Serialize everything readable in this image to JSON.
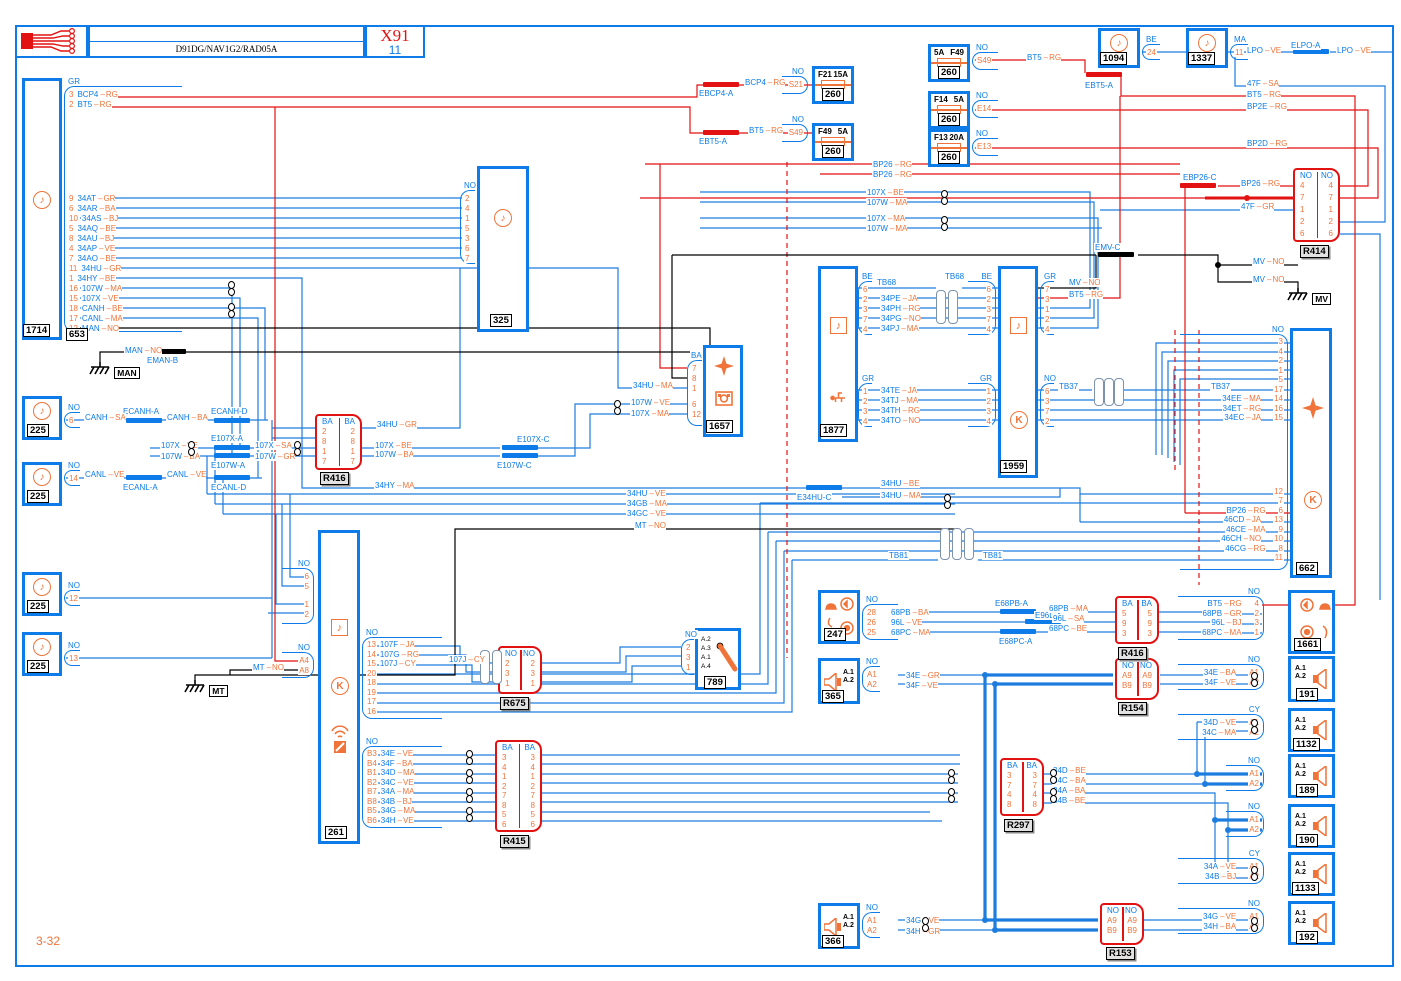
{
  "header": {
    "product": "D91DG/NAV1G2/RAD05A",
    "code": "X91",
    "sheet": "11"
  },
  "footer": {
    "page": "3-32"
  },
  "g": {
    "man": "MAN",
    "mt": "MT",
    "mv": "MV"
  },
  "s": {
    "eman": "EMAN-B",
    "ecanh_a": "ECANH-A",
    "ecanh_d": "ECANH-D",
    "ecanl_a": "ECANL-A",
    "ecanl_d": "ECANL-D",
    "e107x_a": "E107X-A",
    "e107w_a": "E107W-A",
    "e107x_c": "E107X-C",
    "e107w_c": "E107W-C",
    "ebcp4": "EBCP4-A",
    "ebt5_a": "EBT5-A",
    "ebt5_b": "EBT5-A",
    "ebp26": "EBP26-C",
    "elpo": "ELPO-A",
    "emv": "EMV-C",
    "e34hu": "E34HU-C",
    "e68pb": "E68PB-A",
    "e96l": "E96L-A",
    "e68pc": "E68PC-A"
  },
  "c1714": {
    "tag": "1714",
    "tag2": "653",
    "conn": "GR",
    "pins_a": [
      {
        "p": "3",
        "n": "BCP4",
        "c": "RG"
      },
      {
        "p": "2",
        "n": "BT5",
        "c": "RG"
      }
    ],
    "pins_b": [
      {
        "p": "9",
        "n": "34AT",
        "c": "GR"
      },
      {
        "p": "6",
        "n": "34AR",
        "c": "BA"
      },
      {
        "p": "10",
        "n": "34AS",
        "c": "BJ"
      },
      {
        "p": "5",
        "n": "34AQ",
        "c": "BE"
      },
      {
        "p": "8",
        "n": "34AU",
        "c": "BJ"
      },
      {
        "p": "4",
        "n": "34AP",
        "c": "VE"
      },
      {
        "p": "7",
        "n": "34AO",
        "c": "BE"
      },
      {
        "p": "11",
        "n": "34HU",
        "c": "GR"
      },
      {
        "p": "1",
        "n": "34HY",
        "c": "BE"
      },
      {
        "p": "16",
        "n": "107W",
        "c": "MA"
      },
      {
        "p": "15",
        "n": "107X",
        "c": "VE"
      },
      {
        "p": "18",
        "n": "CANH",
        "c": "BE"
      },
      {
        "p": "17",
        "n": "CANL",
        "c": "MA"
      },
      {
        "p": "12",
        "n": "MAN",
        "c": "NO"
      }
    ]
  },
  "b225": [
    {
      "tag": "225",
      "conn": "NO",
      "p": "6"
    },
    {
      "tag": "225",
      "conn": "NO",
      "p": "14"
    },
    {
      "tag": "225",
      "conn": "NO",
      "p": "12"
    },
    {
      "tag": "225",
      "conn": "NO",
      "p": "13"
    }
  ],
  "c325": {
    "tag": "325",
    "conn": "NO",
    "pins": [
      "2",
      "4",
      "1",
      "5",
      "3",
      "6",
      "7"
    ]
  },
  "c1657": {
    "tag": "1657",
    "conn": "BA",
    "pins1": [
      {
        "p": "7"
      },
      {
        "p": "8"
      },
      {
        "p": "1",
        "n": "34HU",
        "c": "MA"
      }
    ],
    "pins2": [
      {
        "p": "6",
        "n": "107W",
        "c": "VE"
      },
      {
        "p": "12",
        "n": "107X",
        "c": "MA"
      }
    ]
  },
  "r416a": {
    "tag": "R416",
    "hl": "BA",
    "hr": "BA",
    "pins": [
      "2",
      "8",
      "1",
      "7"
    ]
  },
  "fusesL": [
    {
      "f1": "F21",
      "f2": "15A",
      "conn": "NO",
      "pin": "S21",
      "tag": "260"
    },
    {
      "f1": "F49",
      "f2": "5A",
      "conn": "NO",
      "pin": "S49",
      "tag": "260"
    }
  ],
  "fusesR": [
    {
      "f1": "5A",
      "f2": "F49",
      "conn": "NO",
      "pin": "S49",
      "tag": "260"
    },
    {
      "f1": "F14",
      "f2": "5A",
      "conn": "NO",
      "pin": "E14",
      "tag": "260"
    },
    {
      "f1": "F13",
      "f2": "20A",
      "conn": "NO",
      "pin": "E13",
      "tag": "260"
    }
  ],
  "c1094": {
    "tag": "1094",
    "conn": "BE",
    "pin": "24"
  },
  "c1337": {
    "tag": "1337",
    "conn": "MA",
    "pin": "11"
  },
  "r414": {
    "tag": "R414",
    "hl": "NO",
    "hr": "NO",
    "pins": [
      "4",
      "7",
      "1",
      "2",
      "6"
    ]
  },
  "c1877": {
    "tag": "1877",
    "connA": "BE",
    "pinsA": [
      {
        "p": "6",
        "n": "TB68",
        "c": ""
      },
      {
        "p": "2",
        "n": "34PE",
        "c": "JA"
      },
      {
        "p": "3",
        "n": "34PH",
        "c": "RG"
      },
      {
        "p": "7",
        "n": "34PG",
        "c": "NO"
      },
      {
        "p": "4",
        "n": "34PJ",
        "c": "MA"
      }
    ],
    "connB": "GR",
    "pinsB": [
      {
        "p": "1",
        "n": "34TE",
        "c": "JA"
      },
      {
        "p": "2",
        "n": "34TJ",
        "c": "MA"
      },
      {
        "p": "3",
        "n": "34TH",
        "c": "RG"
      },
      {
        "p": "4",
        "n": "34TO",
        "c": "NO"
      }
    ]
  },
  "c1959": {
    "tag": "1959",
    "connL1": "BE",
    "pinsL1": [
      "6",
      "2",
      "3",
      "7",
      "4"
    ],
    "connL2": "GR",
    "pinsL2": [
      "1",
      "2",
      "3",
      "4"
    ],
    "connR1": "GR",
    "pinsR1": [
      "7",
      "3",
      "1",
      "2",
      "4"
    ],
    "connR2": "NO",
    "pinsR2": [
      "6",
      "3",
      "7",
      "2"
    ]
  },
  "c662": {
    "tag": "662",
    "conn": "NO",
    "pins1": [
      {
        "p": "3"
      },
      {
        "p": "4"
      },
      {
        "p": "2"
      },
      {
        "p": "1"
      },
      {
        "p": "5"
      },
      {
        "p": "17"
      },
      {
        "p": "14",
        "n": "34EE",
        "c": "MA"
      },
      {
        "p": "16",
        "n": "34ET",
        "c": "RG"
      },
      {
        "p": "15",
        "n": "34EC",
        "c": "JA"
      }
    ],
    "pins2": [
      {
        "p": "12"
      },
      {
        "p": "7"
      },
      {
        "p": "6",
        "n": "BP26",
        "c": "RG"
      },
      {
        "p": "13",
        "n": "46CD",
        "c": "JA"
      },
      {
        "p": "9",
        "n": "46CE",
        "c": "MA"
      },
      {
        "p": "10",
        "n": "46CH",
        "c": "NO"
      },
      {
        "p": "8",
        "n": "46CG",
        "c": "RG"
      },
      {
        "p": "11"
      }
    ]
  },
  "c261": {
    "tag": "261",
    "connTL": "NO",
    "pinsTL1": [
      "6",
      "5"
    ],
    "pinsTL2": [
      "1",
      "2"
    ],
    "connBL": "NO",
    "pinsBL": [
      "A4",
      "A8"
    ],
    "connR1": "NO",
    "pinsR1": [
      {
        "p": "13",
        "n": "107F",
        "c": "JA"
      },
      {
        "p": "14",
        "n": "107G",
        "c": "RG"
      },
      {
        "p": "15",
        "n": "107J",
        "c": "CY"
      },
      {
        "p": "20"
      },
      {
        "p": "18"
      },
      {
        "p": "19"
      },
      {
        "p": "17"
      },
      {
        "p": "16"
      }
    ],
    "connR2": "NO",
    "pinsR2": [
      {
        "p": "B3",
        "n": "34E",
        "c": "VE"
      },
      {
        "p": "B4",
        "n": "34F",
        "c": "BA"
      },
      {
        "p": "B1",
        "n": "34D",
        "c": "MA"
      },
      {
        "p": "B2",
        "n": "34C",
        "c": "VE"
      },
      {
        "p": "B7",
        "n": "34A",
        "c": "MA"
      },
      {
        "p": "B8",
        "n": "34B",
        "c": "BJ"
      },
      {
        "p": "B5",
        "n": "34G",
        "c": "MA"
      },
      {
        "p": "B6",
        "n": "34H",
        "c": "VE"
      }
    ]
  },
  "r675": {
    "tag": "R675",
    "hl": "NO",
    "hr": "NO",
    "pins": [
      "2",
      "3",
      "1"
    ]
  },
  "c789": {
    "tag": "789",
    "conn": "NO",
    "pins": [
      "2",
      "3",
      "1"
    ],
    "labels": [
      "A.2",
      "A.3",
      "A.1",
      "A.4"
    ]
  },
  "r415": {
    "tag": "R415",
    "hl": "BA",
    "hr": "BA",
    "pins": [
      "3",
      "4",
      "1",
      "2",
      "7",
      "8",
      "5",
      "6"
    ]
  },
  "c247": {
    "tag": "247",
    "conn": "NO",
    "pins": [
      {
        "p": "28",
        "n": "68PB",
        "c": "BA"
      },
      {
        "p": "26",
        "n": "96L",
        "c": "VE"
      },
      {
        "p": "25",
        "n": "68PC",
        "c": "MA"
      }
    ]
  },
  "r416b": {
    "tag": "R416",
    "hl": "BA",
    "hr": "BA",
    "pins": [
      "5",
      "9",
      "3"
    ]
  },
  "c1661": {
    "tag": "1661",
    "conn": "NO",
    "pins": [
      {
        "p": "4",
        "n": "BT5",
        "c": "RG"
      },
      {
        "p": "2",
        "n": "68PB",
        "c": "GR"
      },
      {
        "p": "3",
        "n": "96L",
        "c": "BJ"
      },
      {
        "p": "1",
        "n": "68PC",
        "c": "MA"
      }
    ]
  },
  "c365": {
    "tag": "365",
    "conn": "NO",
    "pins": [
      {
        "p": "A1",
        "n": "34E",
        "c": "GR"
      },
      {
        "p": "A2",
        "n": "34F",
        "c": "VE"
      }
    ],
    "spk": [
      "A.1",
      "A.2"
    ]
  },
  "r154": {
    "tag": "R154",
    "hl": "NO",
    "hr": "NO",
    "pins": [
      "A9",
      "B9"
    ]
  },
  "c191": {
    "tag": "191",
    "conn": "NO",
    "pins": [
      {
        "p": "A1",
        "n": "34E",
        "c": "BA"
      },
      {
        "p": "A2",
        "n": "34F",
        "c": "VE"
      }
    ],
    "spk": [
      "A.1",
      "A.2"
    ]
  },
  "c1132": {
    "tag": "1132",
    "conn": "CY",
    "pins": [
      {
        "p": "A1",
        "n": "34D",
        "c": "VE"
      },
      {
        "p": "A2",
        "n": "34C",
        "c": "MA"
      }
    ],
    "spk": [
      "A.1",
      "A.2"
    ]
  },
  "c189": {
    "tag": "189",
    "conn": "NO",
    "pins": [
      {
        "p": "A1"
      },
      {
        "p": "A2"
      }
    ],
    "spk": [
      "A.1",
      "A.2"
    ]
  },
  "c190": {
    "tag": "190",
    "conn": "NO",
    "pins": [
      {
        "p": "A1"
      },
      {
        "p": "A2"
      }
    ],
    "spk": [
      "A.1",
      "A.2"
    ]
  },
  "c1133": {
    "tag": "1133",
    "conn": "CY",
    "pins": [
      {
        "p": "A1",
        "n": "34A",
        "c": "VE"
      },
      {
        "p": "A2",
        "n": "34B",
        "c": "BJ"
      }
    ],
    "spk": [
      "A.1",
      "A.2"
    ]
  },
  "c192": {
    "tag": "192",
    "conn": "NO",
    "pins": [
      {
        "p": "A1",
        "n": "34G",
        "c": "VE"
      },
      {
        "p": "A2",
        "n": "34H",
        "c": "BA"
      }
    ],
    "spk": [
      "A.1",
      "A.2"
    ]
  },
  "r297": {
    "tag": "R297",
    "hl": "BA",
    "hr": "BA",
    "pins": [
      "3",
      "7",
      "4",
      "8"
    ]
  },
  "c366": {
    "tag": "366",
    "conn": "NO",
    "pins": [
      {
        "p": "A1",
        "n": "34G",
        "c": "VE"
      },
      {
        "p": "A2",
        "n": "34H",
        "c": "GR"
      }
    ],
    "spk": [
      "A.1",
      "A.2"
    ]
  },
  "r153": {
    "tag": "R153",
    "hl": "NO",
    "hr": "NO",
    "pins": [
      "A9",
      "B9"
    ]
  },
  "f": {
    "hu_gr": {
      "n": "34HU",
      "c": "GR"
    },
    "x_be": {
      "n": "107X",
      "c": "BE"
    },
    "w_ba": {
      "n": "107W",
      "c": "BA"
    },
    "hy_ma": {
      "n": "34HY",
      "c": "MA"
    },
    "hu_ma": {
      "n": "34HU",
      "c": "MA"
    },
    "w_ve": {
      "n": "107W",
      "c": "VE"
    },
    "x_ma": {
      "n": "107X",
      "c": "MA"
    },
    "canh1": {
      "n": "CANH",
      "c": "SA"
    },
    "canh2": {
      "n": "CANH",
      "c": "BA"
    },
    "canl1": {
      "n": "CANL",
      "c": "VE"
    },
    "canl2": {
      "n": "CANL",
      "c": "VE"
    },
    "x_ve": {
      "n": "107X",
      "c": "VE"
    },
    "x_sa": {
      "n": "107X",
      "c": "SA"
    },
    "w_ba2": {
      "n": "107W",
      "c": "BA"
    },
    "w_gr": {
      "n": "107W",
      "c": "GR"
    },
    "bcp4": {
      "n": "BCP4",
      "c": "RG"
    },
    "bt5a": {
      "n": "BT5",
      "c": "RG"
    },
    "bt5b": {
      "n": "BT5",
      "c": "RG"
    },
    "bt5c": {
      "n": "BT5",
      "c": "RG"
    },
    "sa47": {
      "n": "47F",
      "c": "SA"
    },
    "bp2e": {
      "n": "BP2E",
      "c": "RG"
    },
    "bp2d": {
      "n": "BP2D",
      "c": "RG"
    },
    "bp26a": {
      "n": "BP26",
      "c": "RG"
    },
    "bp26b": {
      "n": "BP26",
      "c": "RG"
    },
    "bp26c": {
      "n": "BP26",
      "c": "RG"
    },
    "gr47": {
      "n": "47F",
      "c": "GR"
    },
    "mx_be": {
      "n": "107X",
      "c": "BE"
    },
    "mw_ma": {
      "n": "107W",
      "c": "MA"
    },
    "mx_ma": {
      "n": "107X",
      "c": "MA"
    },
    "mw_ma2": {
      "n": "107W",
      "c": "MA"
    },
    "lpo1": {
      "n": "LPO",
      "c": "VE"
    },
    "lpo2": {
      "n": "LPO",
      "c": "VE"
    },
    "mv1": {
      "n": "MV",
      "c": "NO"
    },
    "mv2": {
      "n": "MV",
      "c": "NO"
    },
    "mv3": {
      "n": "MV",
      "c": "NO"
    },
    "bt1959": {
      "n": "BT5",
      "c": "RG"
    },
    "tb68a": "TB68",
    "tb68b": "TB68",
    "tb37a": "TB37",
    "tb37b": "TB37",
    "tb81a": "TB81",
    "tb81b": "TB81",
    "hu_be": {
      "n": "34HU",
      "c": "BE"
    },
    "hu_ma2": {
      "n": "34HU",
      "c": "MA"
    },
    "hu_ve": {
      "n": "34HU",
      "c": "VE"
    },
    "gb_ma": {
      "n": "34GB",
      "c": "MA"
    },
    "gc_ve": {
      "n": "34GC",
      "c": "VE"
    },
    "mt1": {
      "n": "MT",
      "c": "NO"
    },
    "mt2": {
      "n": "MT",
      "c": "NO"
    },
    "man": {
      "n": "MAN",
      "c": "NO"
    },
    "j107": {
      "n": "107J",
      "c": "CY"
    },
    "pb_ma": {
      "n": "68PB",
      "c": "MA"
    },
    "gl_sa": {
      "n": "96L",
      "c": "SA"
    },
    "pc_be": {
      "n": "68PC",
      "c": "BE"
    },
    "d_be": {
      "n": "34D",
      "c": "BE"
    },
    "c_ba": {
      "n": "34C",
      "c": "BA"
    },
    "a_ba": {
      "n": "34A",
      "c": "BA"
    },
    "b_be": {
      "n": "34B",
      "c": "BE"
    }
  }
}
